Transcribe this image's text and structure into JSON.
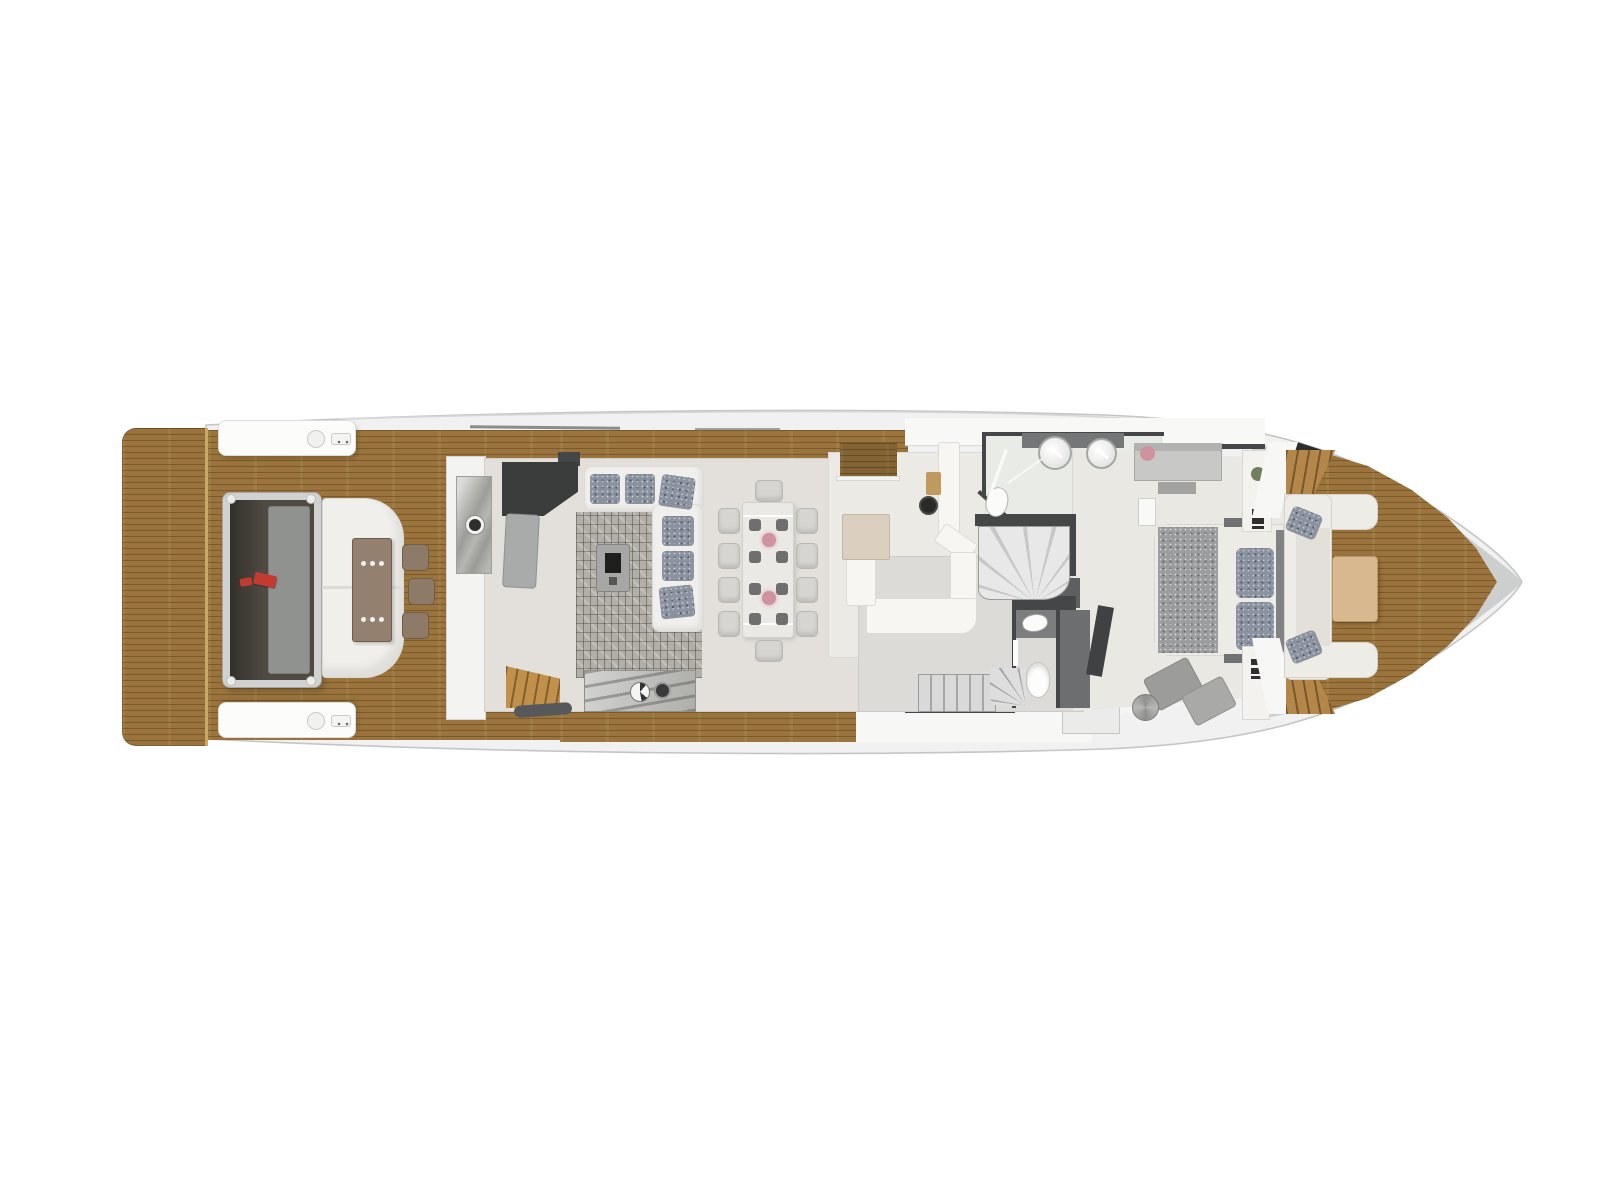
{
  "scene": {
    "type": "yacht-main-deck-floor-plan",
    "view": "top-down-3d-render",
    "orientation": "bow-right-stern-left",
    "background": "#ffffff",
    "visible_text": ""
  },
  "colors": {
    "teak": "#9a743c",
    "teakLight": "#b3874a",
    "teakSeam": "#c9a869",
    "hullFill": "#f0f1f0",
    "hullEdge": "#c4c6c5",
    "bowGray": "#cdcfce",
    "white": "#fbfbf9",
    "wall": "#444647",
    "floorSalon": "#e3e0db",
    "floorGalley": "#eceae4",
    "floorHall": "#dddbd7",
    "floorBath": "#e9ece6",
    "floorCabin": "#eae8e3",
    "sofa": "#f1efec",
    "cushion": "#8b93a0",
    "rugBase": "#b2aea8",
    "marble": "#b6b7b3",
    "counter": "#f7f6f3",
    "islandBeige": "#dbcfc0",
    "chair": "#d7d5d1",
    "tableGray": "#a7a8a6",
    "settingDark": "#6e6f6e",
    "floralPink": "#cf93a0",
    "sinkDark": "#2a2a2a",
    "boardTan": "#bf9a5e",
    "bedWhite": "#edebe6",
    "bedSpeckle": "#9c9d9f",
    "benchGray": "#c8c8c6",
    "chaiseGray": "#9c9c9a",
    "headboard": "#808284",
    "vanityGray": "#747678",
    "wardrobe": "#6c6e70",
    "aftFrame": "#d0d1d0",
    "aftInner": "#4f4a42",
    "aftPanel": "#90928f",
    "aftTable": "#93806f",
    "stoolBrown": "#8e7b67",
    "redAccent": "#c23a30",
    "bowTable": "#d8b98f",
    "fixtureWhite": "#fdfdfb"
  },
  "areas": [
    {
      "id": "swim-platform",
      "kind": "teak deck"
    },
    {
      "id": "aft-deck",
      "kind": "teak deck with lounge, sunpad, table, stools"
    },
    {
      "id": "side-decks",
      "kind": "teak walkways port and starboard"
    },
    {
      "id": "salon",
      "kind": "L-sofa, rug, coffee table, sideboard"
    },
    {
      "id": "dining",
      "kind": "table for ten with place settings"
    },
    {
      "id": "galley",
      "kind": "U-shaped counter, island, sink"
    },
    {
      "id": "spiral-staircase",
      "kind": "stair to upper deck"
    },
    {
      "id": "bathroom",
      "kind": "twin sinks, shower, toilet"
    },
    {
      "id": "day-head",
      "kind": "sink and toilet"
    },
    {
      "id": "stairs-down",
      "kind": "stair to lower deck"
    },
    {
      "id": "master-cabin",
      "kind": "bed, nightstands, chaise"
    },
    {
      "id": "bow-seating",
      "kind": "U-sofa with table on foredeck"
    },
    {
      "id": "bow-deck",
      "kind": "pointed teak foredeck"
    }
  ]
}
